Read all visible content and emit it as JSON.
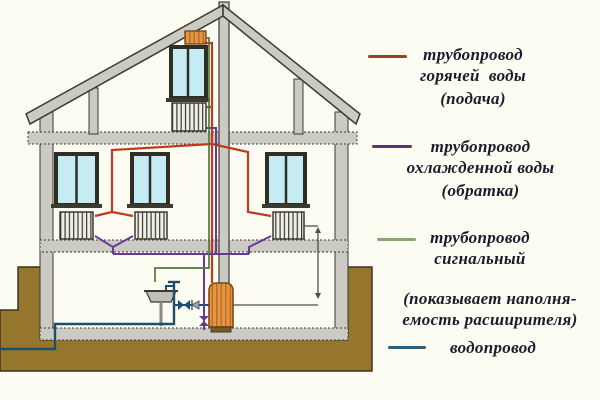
{
  "legend": {
    "items": [
      {
        "id": "supply",
        "color": "#a23c2e",
        "lines": [
          "трубопровод",
          "горячей  воды",
          "(подача)"
        ]
      },
      {
        "id": "return",
        "color": "#5a3478",
        "lines": [
          "трубопровод",
          "охлажденной воды",
          "(обратка)"
        ]
      },
      {
        "id": "signal",
        "color": "#8aa56e",
        "lines": [
          "трубопровод",
          "сигнальный"
        ]
      },
      {
        "id": "signal-note",
        "color": null,
        "lines": [
          "(показывает наполня-",
          "емость расширителя)"
        ]
      },
      {
        "id": "water",
        "color": "#305f7e",
        "lines": [
          "водопровод"
        ]
      }
    ]
  },
  "colors": {
    "bg": "#fdfcf2",
    "text": "#1b1b2e",
    "ground": "#96752c",
    "ground-line": "#3a3422",
    "wall": "#cbcbc3",
    "outline": "#3a3a30",
    "glass": "#c5ecf2",
    "frame": "#2e2e24",
    "sill": "#3a3a30",
    "metal": "#e59643",
    "metal-hatch": "#c06e28",
    "metal-edge": "#7a4a14",
    "radiator-fill": "#efefe7",
    "radiator-line": "#3a3a32",
    "sink": "#c0c0b8",
    "supply": "#c0391f",
    "return": "#6a3a92",
    "signal": "#4e7a3c",
    "water": "#1e4e6e",
    "indicator": "#4b5244"
  },
  "diagram": {
    "components": [
      "house-cross-section",
      "roof",
      "chimney",
      "expansion-tank",
      "attic-window",
      "attic-radiator",
      "floor-windows",
      "floor-radiators",
      "boiler",
      "sink",
      "faucet",
      "shutoff-valves",
      "check-valve",
      "supply-riser",
      "return-collector",
      "signal-pipe",
      "water-main",
      "ground"
    ]
  }
}
